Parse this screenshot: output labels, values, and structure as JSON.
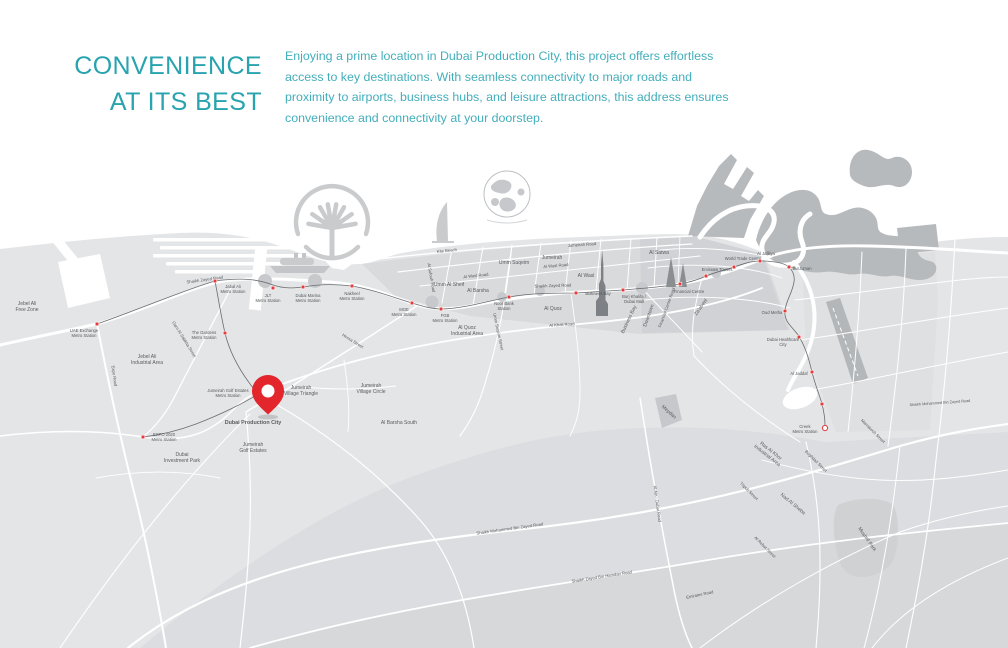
{
  "header": {
    "title_line1": "CONVENIENCE",
    "title_line2": "AT ITS BEST",
    "description": "Enjoying a prime location in Dubai Production City, this project offers effortless access to key destinations. With seamless connectivity to major roads and proximity to airports, business hubs, and leisure attractions, this address ensures convenience and connectivity at your doorstep."
  },
  "colors": {
    "title_teal": "#28a3af",
    "body_teal": "#43aebb",
    "map_land": "#e4e5e7",
    "map_blocks": "#d9dadc",
    "map_dense_blocks": "#d0d2d5",
    "map_coast_mass": "#b7babd",
    "road_white": "#ffffff",
    "metro_line": "#6a6d70",
    "station_red": "#e23b3d",
    "pin_red": "#e2262b",
    "label_gray": "#595c5f"
  },
  "map": {
    "pin": {
      "x": 268,
      "y": 414,
      "label": "Dubai Production City"
    },
    "stations": [
      {
        "name": "UAE Exchange\nMetro Station",
        "x": 97,
        "y": 324,
        "lx": 84,
        "ly": 332
      },
      {
        "name": "Jabal Ali\nMetro Station",
        "x": 215,
        "y": 281,
        "lx": 233,
        "ly": 288
      },
      {
        "name": "The Gardens\nMetro Station",
        "x": 225,
        "y": 333,
        "lx": 204,
        "ly": 334
      },
      {
        "name": "JLT\nMetro Station",
        "x": 273,
        "y": 288,
        "lx": 268,
        "ly": 297
      },
      {
        "name": "Dubai Marina\nMetro Station",
        "x": 303,
        "y": 287,
        "lx": 308,
        "ly": 297
      },
      {
        "name": "Nakheel\nMetro Station",
        "x": 352,
        "y": 286,
        "lx": 352,
        "ly": 295
      },
      {
        "name": "MOE\nMetro Station",
        "x": 412,
        "y": 303,
        "lx": 404,
        "ly": 311
      },
      {
        "name": "FGB\nMetro Station",
        "x": 441,
        "y": 309,
        "lx": 445,
        "ly": 317
      },
      {
        "name": "Noor Bank\nStation",
        "x": 509,
        "y": 297,
        "lx": 504,
        "ly": 305
      },
      {
        "name": "Business Bay",
        "x": 576,
        "y": 293,
        "lx": 598,
        "ly": 295
      },
      {
        "name": "Burj Khalifa /\nDubai Mall",
        "x": 623,
        "y": 290,
        "lx": 634,
        "ly": 298
      },
      {
        "name": "Financial Centre",
        "x": 680,
        "y": 284,
        "lx": 689,
        "ly": 293
      },
      {
        "name": "Emirates Towers",
        "x": 706,
        "y": 276,
        "lx": 717,
        "ly": 271
      },
      {
        "name": "World Trade Centre",
        "x": 734,
        "y": 267,
        "lx": 743,
        "ly": 260
      },
      {
        "name": "Al Jafiliya",
        "x": 760,
        "y": 261,
        "lx": 766,
        "ly": 255
      },
      {
        "name": "BurJuman",
        "x": 789,
        "y": 267,
        "lx": 802,
        "ly": 270
      },
      {
        "name": "Oud Metha",
        "x": 785,
        "y": 311,
        "lx": 772,
        "ly": 314
      },
      {
        "name": "Dubai Healthcare\nCity",
        "x": 799,
        "y": 337,
        "lx": 783,
        "ly": 341
      },
      {
        "name": "Al Jaddaf",
        "x": 812,
        "y": 372,
        "lx": 799,
        "ly": 375
      },
      {
        "name": "",
        "x": 822,
        "y": 404,
        "lx": 0,
        "ly": 0
      },
      {
        "name": "Creek\nMetro Station",
        "x": 825,
        "y": 428,
        "lx": 805,
        "ly": 428,
        "ring": true
      },
      {
        "name": "Jumeirah Golf Estates\nMetro Station",
        "x": 258,
        "y": 394,
        "lx": 228,
        "ly": 392
      },
      {
        "name": "EXPO 2020\nMetro Station",
        "x": 143,
        "y": 437,
        "lx": 164,
        "ly": 436
      }
    ],
    "area_labels": [
      {
        "t": "Jebel Ali\nFree Zone",
        "x": 27,
        "y": 305
      },
      {
        "t": "Jebel Ali\nIndustrial Area",
        "x": 147,
        "y": 358
      },
      {
        "t": "Dubai\nInvestment Park",
        "x": 182,
        "y": 456
      },
      {
        "t": "Dubai Production City",
        "x": 253,
        "y": 424,
        "size": 5.4,
        "bold": true
      },
      {
        "t": "Jumeirah\nGolf Estates",
        "x": 253,
        "y": 446
      },
      {
        "t": "Jumeirah\nVillage Triangle",
        "x": 301,
        "y": 389
      },
      {
        "t": "Jumeirah\nVillage Circle",
        "x": 371,
        "y": 387
      },
      {
        "t": "Al Barsha South",
        "x": 399,
        "y": 424
      },
      {
        "t": "Umm Al Sheif",
        "x": 449,
        "y": 286
      },
      {
        "t": "Al Barsha",
        "x": 478,
        "y": 292
      },
      {
        "t": "Umm Suqeim",
        "x": 514,
        "y": 264
      },
      {
        "t": "Jumeirah",
        "x": 552,
        "y": 259
      },
      {
        "t": "Al Quoz",
        "x": 553,
        "y": 310
      },
      {
        "t": "Al Quoz\nIndustrial Area",
        "x": 467,
        "y": 329
      },
      {
        "t": "Al Wasl",
        "x": 586,
        "y": 277
      },
      {
        "t": "Al Satwa",
        "x": 659,
        "y": 254
      },
      {
        "t": "Downtown",
        "x": 650,
        "y": 316,
        "rot": -70
      },
      {
        "t": "Business Bay",
        "x": 630,
        "y": 320,
        "rot": -65
      },
      {
        "t": "Za'abeel",
        "x": 702,
        "y": 308,
        "rot": -55
      },
      {
        "t": "Meydan",
        "x": 668,
        "y": 413,
        "rot": 42
      },
      {
        "t": "Nad Al Sheba",
        "x": 792,
        "y": 505,
        "rot": 40
      },
      {
        "t": "Ras Al Khor\nIndustrial Area",
        "x": 770,
        "y": 452,
        "rot": 38
      },
      {
        "t": "Mushrif Park",
        "x": 866,
        "y": 540,
        "rot": 55
      }
    ],
    "road_labels": [
      {
        "t": "Shaikh Zayed Road",
        "x": 205,
        "y": 281,
        "rot": -8
      },
      {
        "t": "Shaikh Zayed Road",
        "x": 553,
        "y": 287,
        "rot": -2
      },
      {
        "t": "Jumeirah Road",
        "x": 582,
        "y": 246,
        "rot": -4
      },
      {
        "t": "Kite Beach",
        "x": 447,
        "y": 252,
        "rot": -6
      },
      {
        "t": "Al Wasl Road",
        "x": 476,
        "y": 277,
        "rot": -6
      },
      {
        "t": "Al Wasl Road",
        "x": 556,
        "y": 267,
        "rot": -5
      },
      {
        "t": "Al Sufouh Road",
        "x": 430,
        "y": 278,
        "rot": 80
      },
      {
        "t": "Hessa Street",
        "x": 352,
        "y": 342,
        "rot": 32
      },
      {
        "t": "Garn Al Sabkha Street",
        "x": 183,
        "y": 340,
        "rot": 58
      },
      {
        "t": "Expo Road",
        "x": 113,
        "y": 376,
        "rot": 82
      },
      {
        "t": "Al Khail Road",
        "x": 562,
        "y": 326,
        "rot": -4
      },
      {
        "t": "Umm Suqeim Street",
        "x": 497,
        "y": 332,
        "rot": 78
      },
      {
        "t": "Financial Centre Road",
        "x": 668,
        "y": 308,
        "rot": -70
      },
      {
        "t": "Shaikh Mohammed Bin Zayed Road",
        "x": 510,
        "y": 530,
        "rot": -8
      },
      {
        "t": "Shaikh Zayed Bin Hamdan Road",
        "x": 602,
        "y": 578,
        "rot": -9
      },
      {
        "t": "Shaikh Mohammed Bin Zayed Road",
        "x": 940,
        "y": 404,
        "rot": -4,
        "size": 3.8
      },
      {
        "t": "Al Ain - Dubai Road",
        "x": 656,
        "y": 504,
        "rot": 82
      },
      {
        "t": "Emirates Road",
        "x": 700,
        "y": 596,
        "rot": -12
      },
      {
        "t": "Tripoli Street",
        "x": 748,
        "y": 492,
        "rot": 45
      },
      {
        "t": "Baghdad Street",
        "x": 815,
        "y": 462,
        "rot": 45
      },
      {
        "t": "Al Rebat Street",
        "x": 764,
        "y": 548,
        "rot": 45
      },
      {
        "t": "Marrakech Street",
        "x": 872,
        "y": 432,
        "rot": 45
      }
    ]
  }
}
